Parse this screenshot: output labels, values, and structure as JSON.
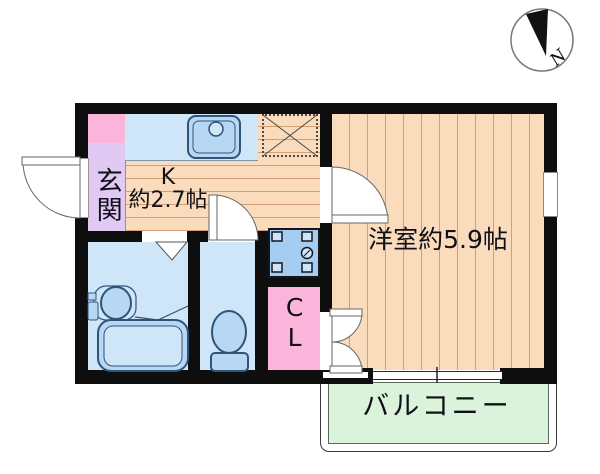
{
  "plan": {
    "kind": "apartment-floor-plan",
    "compass": {
      "north_label": "N"
    },
    "rooms": {
      "entrance": {
        "label": "玄関"
      },
      "kitchen": {
        "label_abbrev": "K",
        "label_size": "約2.7帖"
      },
      "western_room": {
        "label": "洋室約5.9帖"
      },
      "closet": {
        "label": "CL"
      },
      "balcony": {
        "label": "バルコニー"
      }
    },
    "fixtures": [
      "kitchen-sink",
      "refrigerator-space",
      "washing-machine-space",
      "washbasin",
      "bathtub",
      "toilet",
      "entrance-door",
      "room-door",
      "toilet-door",
      "bathroom-folding-door",
      "closet-double-door",
      "sliding-window"
    ],
    "colors": {
      "wall": "#0e0e0e",
      "wood_floor": "#fadcbd",
      "wood_floor_line": "#cfa078",
      "water_room_floor": "#cfe5f8",
      "fixture_fill": "#b7d7f3",
      "fixture_line": "#2f547a",
      "entrance_floor": "#e0c9f3",
      "closet_pink": "#fcb5da",
      "balcony_green": "#dbf2db",
      "washer_space_blue": "#a4cdf1"
    }
  }
}
